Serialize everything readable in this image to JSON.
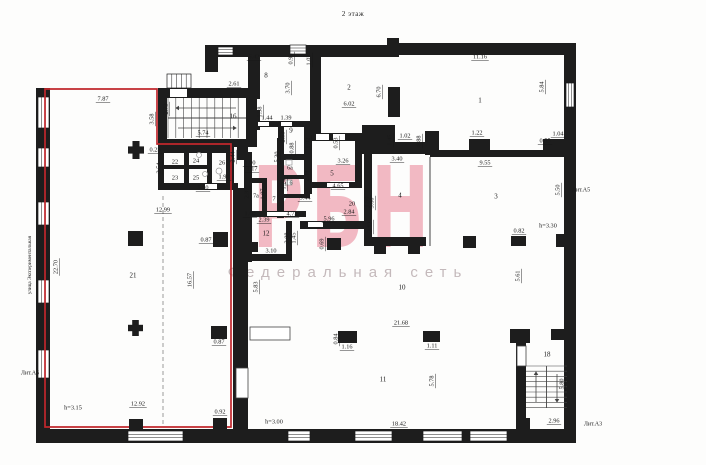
{
  "title": "2 этаж",
  "watermark": {
    "text": "РБН",
    "subtext": "Федеральная сеть",
    "color": "#e5697f",
    "subtext_color": "#c2b6b8"
  },
  "plan": {
    "width": 706,
    "height": 465,
    "colors": {
      "wall": "#1d1d1d",
      "red_outline": "#c0272d",
      "thin": "#444444",
      "light": "#9a9a9a",
      "text": "#1a1a1a"
    },
    "red_outline": "45,89 157,89 157,144 231,144 231,427 45,427",
    "walls": [
      [
        36,
        88,
        14,
        342
      ],
      [
        36,
        429,
        540,
        14
      ],
      [
        564,
        43,
        12,
        400
      ],
      [
        205,
        45,
        190,
        12
      ],
      [
        387,
        38,
        12,
        19
      ],
      [
        395,
        43,
        171,
        12
      ],
      [
        205,
        47,
        13,
        25
      ],
      [
        543,
        139,
        30,
        15
      ],
      [
        556,
        234,
        9,
        13
      ],
      [
        551,
        329,
        22,
        11
      ],
      [
        158,
        88,
        99,
        10
      ],
      [
        158,
        95,
        9,
        50
      ],
      [
        246,
        88,
        11,
        57
      ],
      [
        158,
        139,
        99,
        8
      ],
      [
        248,
        57,
        12,
        42
      ],
      [
        248,
        110,
        12,
        20
      ],
      [
        310,
        57,
        11,
        79
      ],
      [
        250,
        121,
        60,
        6
      ],
      [
        278,
        127,
        6,
        30
      ],
      [
        278,
        154,
        32,
        6
      ],
      [
        310,
        133,
        54,
        8
      ],
      [
        362,
        125,
        33,
        29
      ],
      [
        395,
        142,
        31,
        12
      ],
      [
        425,
        131,
        14,
        24
      ],
      [
        430,
        150,
        136,
        7
      ],
      [
        277,
        138,
        7,
        80
      ],
      [
        284,
        154,
        26,
        5
      ],
      [
        284,
        175,
        26,
        4
      ],
      [
        284,
        194,
        26,
        4
      ],
      [
        304,
        127,
        8,
        67
      ],
      [
        355,
        139,
        7,
        47
      ],
      [
        306,
        182,
        56,
        6
      ],
      [
        364,
        139,
        8,
        99
      ],
      [
        364,
        237,
        62,
        9
      ],
      [
        374,
        246,
        12,
        8
      ],
      [
        408,
        246,
        12,
        8
      ],
      [
        237,
        140,
        11,
        20
      ],
      [
        244,
        152,
        8,
        110
      ],
      [
        244,
        178,
        22,
        5
      ],
      [
        262,
        178,
        5,
        36
      ],
      [
        244,
        211,
        62,
        6
      ],
      [
        300,
        221,
        64,
        8
      ],
      [
        286,
        221,
        6,
        40
      ],
      [
        246,
        254,
        44,
        7
      ],
      [
        248,
        242,
        10,
        10
      ],
      [
        226,
        143,
        8,
        47
      ],
      [
        158,
        147,
        76,
        6
      ],
      [
        158,
        147,
        6,
        42
      ],
      [
        158,
        183,
        80,
        7
      ],
      [
        184,
        147,
        5,
        42
      ],
      [
        207,
        147,
        5,
        42
      ],
      [
        158,
        165,
        28,
        4
      ],
      [
        184,
        165,
        28,
        4
      ],
      [
        233,
        188,
        15,
        242
      ],
      [
        510,
        329,
        20,
        14
      ],
      [
        516,
        343,
        10,
        87
      ],
      [
        388,
        87,
        12,
        30
      ],
      [
        516,
        418,
        14,
        12
      ]
    ],
    "windows": [
      [
        38,
        97,
        11,
        31,
        "v",
        2
      ],
      [
        38,
        148,
        11,
        19,
        "v",
        2
      ],
      [
        38,
        202,
        11,
        23,
        "v",
        2
      ],
      [
        38,
        280,
        11,
        23,
        "v",
        2
      ],
      [
        38,
        350,
        11,
        28,
        "v",
        2
      ],
      [
        566,
        83,
        8,
        24,
        "v",
        2
      ],
      [
        128,
        431,
        55,
        10,
        "h",
        2
      ],
      [
        288,
        431,
        22,
        10,
        "h",
        2
      ],
      [
        355,
        431,
        37,
        10,
        "h",
        2
      ],
      [
        423,
        431,
        39,
        10,
        "h",
        2
      ],
      [
        470,
        431,
        37,
        10,
        "h",
        2
      ],
      [
        218,
        47,
        15,
        8,
        "h",
        2
      ],
      [
        290,
        45,
        16,
        9,
        "h",
        2
      ],
      [
        167,
        74,
        24,
        14,
        "v",
        4
      ]
    ],
    "openings": [
      [
        170,
        89,
        17,
        8
      ],
      [
        258,
        122,
        11,
        4
      ],
      [
        281,
        122,
        11,
        4
      ],
      [
        316,
        134,
        13,
        6
      ],
      [
        333,
        134,
        12,
        6
      ],
      [
        327,
        183,
        22,
        4
      ],
      [
        267,
        212,
        28,
        4
      ],
      [
        308,
        222,
        15,
        5
      ],
      [
        205,
        184,
        12,
        5
      ]
    ],
    "doors": [
      [
        250,
        327,
        40,
        13
      ],
      [
        517,
        346,
        9,
        20
      ],
      [
        236,
        368,
        12,
        30
      ]
    ],
    "partitions": [
      [
        163,
        196,
        163,
        427,
        1
      ],
      [
        430,
        157,
        430,
        246,
        0
      ]
    ],
    "stairs": [
      {
        "x": 168,
        "y": 98,
        "w": 78,
        "h": 40,
        "dir": "h",
        "step": 7.8,
        "arrows": [
          [
            236,
            108,
            176,
            108
          ],
          [
            178,
            128,
            236,
            128
          ]
        ]
      },
      {
        "x": 526,
        "y": 366,
        "w": 41,
        "h": 42,
        "dir": "v",
        "step": 5.2,
        "arrows": [
          [
            536,
            402,
            536,
            372
          ],
          [
            557,
            374,
            557,
            402
          ]
        ]
      }
    ],
    "columns": [
      {
        "s": "p",
        "x": 128,
        "y": 141,
        "w": 16,
        "h": 18
      },
      {
        "s": "r",
        "x": 128,
        "y": 231,
        "w": 15,
        "h": 15
      },
      {
        "s": "r",
        "x": 213,
        "y": 232,
        "w": 15,
        "h": 15
      },
      {
        "s": "p",
        "x": 128,
        "y": 320,
        "w": 15,
        "h": 16
      },
      {
        "s": "r",
        "x": 211,
        "y": 326,
        "w": 16,
        "h": 13
      },
      {
        "s": "r",
        "x": 129,
        "y": 419,
        "w": 14,
        "h": 11
      },
      {
        "s": "r",
        "x": 213,
        "y": 418,
        "w": 14,
        "h": 11
      },
      {
        "s": "r",
        "x": 469,
        "y": 139,
        "w": 21,
        "h": 16
      },
      {
        "s": "r",
        "x": 463,
        "y": 236,
        "w": 13,
        "h": 12
      },
      {
        "s": "r",
        "x": 511,
        "y": 236,
        "w": 15,
        "h": 10
      },
      {
        "s": "r",
        "x": 338,
        "y": 331,
        "w": 19,
        "h": 12
      },
      {
        "s": "r",
        "x": 423,
        "y": 331,
        "w": 17,
        "h": 11
      },
      {
        "s": "r",
        "x": 327,
        "y": 238,
        "w": 14,
        "h": 12
      }
    ],
    "fixtures": [
      {
        "s": "c",
        "x": 199,
        "y": 155,
        "r": 2.5
      },
      {
        "s": "c",
        "x": 205,
        "y": 174,
        "r": 2.5
      },
      {
        "s": "c",
        "x": 219,
        "y": 171,
        "r": 3
      },
      {
        "s": "r",
        "x": 286,
        "y": 160,
        "w": 6,
        "h": 5
      },
      {
        "s": "r",
        "x": 286,
        "y": 180,
        "w": 6,
        "h": 5
      }
    ],
    "labels": [
      [
        "7.87",
        103,
        99
      ],
      [
        "5.42",
        254,
        57
      ],
      [
        "2.61",
        234,
        84
      ],
      [
        "5.74",
        203,
        133
      ],
      [
        "16",
        233,
        117,
        0,
        7
      ],
      [
        "8",
        266,
        76,
        0,
        7
      ],
      [
        "9",
        291,
        131,
        0,
        7
      ],
      [
        "1.44",
        267,
        118
      ],
      [
        "1.39",
        286,
        118
      ],
      [
        "2",
        349,
        88,
        0,
        7
      ],
      [
        "6.02",
        349,
        104
      ],
      [
        "11.16",
        480,
        57
      ],
      [
        "1",
        480,
        101,
        0,
        7
      ],
      [
        "1.02",
        405,
        136
      ],
      [
        "3.40",
        397,
        159
      ],
      [
        "1.22",
        477,
        133
      ],
      [
        "9.55",
        485,
        163
      ],
      [
        "0.55",
        545,
        141
      ],
      [
        "1.04",
        558,
        134
      ],
      [
        "0.25",
        155,
        150
      ],
      [
        "22",
        175,
        162,
        0,
        6.5
      ],
      [
        "24",
        196,
        161,
        0,
        6.5
      ],
      [
        "26",
        222,
        163,
        0,
        6.5
      ],
      [
        "23",
        175,
        178,
        0,
        6.5
      ],
      [
        "25",
        196,
        178,
        0,
        6.5
      ],
      [
        "1.99",
        224,
        177
      ],
      [
        "5.10",
        203,
        188
      ],
      [
        "1.00",
        250,
        163
      ],
      [
        "1.17",
        252,
        169
      ],
      [
        "3.26",
        343,
        161
      ],
      [
        "5",
        332,
        174,
        0,
        7
      ],
      [
        "4.65",
        338,
        186
      ],
      [
        "3.44",
        305,
        198
      ],
      [
        "6a",
        290,
        168,
        0,
        6
      ],
      [
        "6",
        291,
        183,
        0,
        6
      ],
      [
        "7",
        274,
        199,
        0,
        6.5
      ],
      [
        "7a",
        256,
        196,
        0,
        6
      ],
      [
        "4",
        400,
        196,
        0,
        7
      ],
      [
        "20",
        352,
        204,
        0,
        6.5
      ],
      [
        "2.84",
        349,
        212
      ],
      [
        "5.96",
        329,
        219
      ],
      [
        "4.73",
        292,
        214
      ],
      [
        "1.00",
        250,
        214
      ],
      [
        "2.39",
        264,
        220
      ],
      [
        "12",
        266,
        234,
        0,
        7
      ],
      [
        "3.10",
        271,
        251
      ],
      [
        "12.99",
        163,
        210
      ],
      [
        "21",
        133,
        276,
        0,
        7
      ],
      [
        "12.92",
        138,
        404
      ],
      [
        "h=3.15",
        73,
        408
      ],
      [
        "0.87",
        206,
        240
      ],
      [
        "0.87",
        219,
        342
      ],
      [
        "0.92",
        220,
        412
      ],
      [
        "h=3.00",
        274,
        422
      ],
      [
        "18.42",
        399,
        424
      ],
      [
        "11",
        383,
        380,
        0,
        7
      ],
      [
        "21.68",
        401,
        323
      ],
      [
        "1.16",
        347,
        347
      ],
      [
        "1.11",
        432,
        346
      ],
      [
        "10",
        402,
        288,
        0,
        7
      ],
      [
        "3",
        496,
        197,
        0,
        7
      ],
      [
        "h=3.30",
        548,
        226
      ],
      [
        "0.82",
        519,
        231
      ],
      [
        "18",
        547,
        355,
        0,
        7
      ],
      [
        "2.96",
        554,
        421
      ],
      [
        "Лит.А3",
        593,
        424,
        0,
        6
      ],
      [
        "Лит.А5",
        581,
        190,
        0,
        6
      ],
      [
        "Лит.А6",
        30,
        373,
        0,
        6
      ],
      [
        "3.58",
        152,
        119,
        1
      ],
      [
        "2.73",
        166,
        109,
        1
      ],
      [
        "2.54",
        159,
        168,
        1
      ],
      [
        "2.44",
        233,
        157,
        1
      ],
      [
        "0.93",
        291,
        59,
        1
      ],
      [
        "1.02",
        309,
        60,
        1
      ],
      [
        "3.70",
        288,
        88,
        1
      ],
      [
        "6.70",
        379,
        92,
        1
      ],
      [
        "1.38",
        260,
        112,
        1
      ],
      [
        "2.53",
        283,
        137,
        1
      ],
      [
        "0.88",
        292,
        148,
        1
      ],
      [
        "5.30",
        277,
        157,
        1
      ],
      [
        "1.02",
        308,
        143,
        1
      ],
      [
        "0.53",
        336,
        143,
        1
      ],
      [
        "2.38",
        307,
        176,
        1
      ],
      [
        "1.24",
        284,
        184,
        1
      ],
      [
        "2.97",
        247,
        193,
        1
      ],
      [
        "1.07",
        263,
        194,
        1
      ],
      [
        "2.08",
        287,
        238,
        1
      ],
      [
        "1.45",
        294,
        238,
        1
      ],
      [
        "0.69",
        322,
        244,
        1
      ],
      [
        "1.45",
        390,
        140,
        1
      ],
      [
        "0.88",
        419,
        141,
        1
      ],
      [
        "1.50",
        367,
        202,
        1
      ],
      [
        "5.60",
        372,
        203,
        1
      ],
      [
        "2.12",
        370,
        227,
        1
      ],
      [
        "5.84",
        542,
        87,
        1
      ],
      [
        "5.50",
        558,
        190,
        1
      ],
      [
        "5.83",
        256,
        287,
        1
      ],
      [
        "5.61",
        518,
        276,
        1
      ],
      [
        "0.84",
        336,
        339,
        1
      ],
      [
        "5.78",
        432,
        381,
        1
      ],
      [
        "16.57",
        190,
        280,
        1
      ],
      [
        "22.70",
        56,
        267,
        1
      ],
      [
        "5.80",
        562,
        384,
        1
      ],
      [
        "улица Экспериментальная",
        30,
        265,
        1,
        5.2
      ]
    ]
  }
}
